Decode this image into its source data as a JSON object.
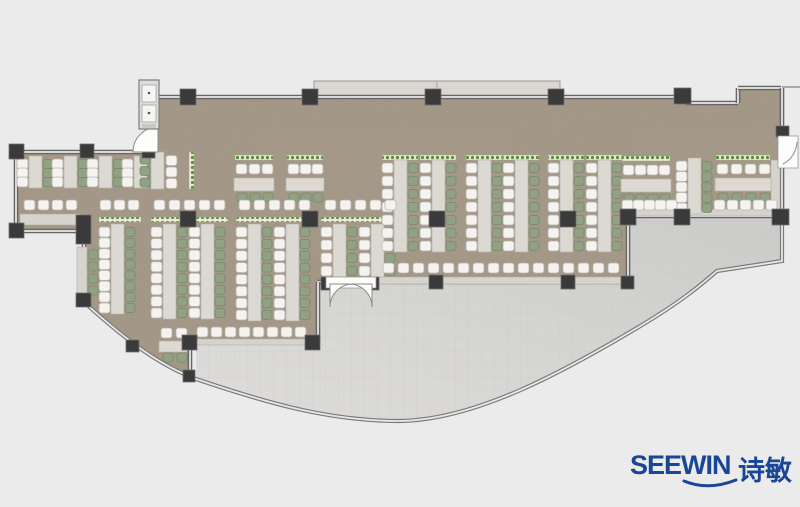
{
  "canvas": {
    "width": 800,
    "height": 507,
    "background": "#ebebeb"
  },
  "logo": {
    "brand": "SEEWIN",
    "cjk": "诗敏",
    "color": "#1a4697"
  },
  "palette": {
    "floor": "#a39685",
    "floor_noise_rgb": "0.40 0.36 0.31",
    "terrace_dark": "#cbcbc9",
    "terrace_light": "#dedddb",
    "tile_line": "#c6c6c4",
    "wall_dark": "#666666",
    "wall_light": "#d9d9d7",
    "glass_dark": "#7a7a7a",
    "glass_light": "#e8e8e6",
    "column": "#3a3a3a",
    "column_edge": "#707070",
    "desk": "#dcd9d2",
    "desk_edge": "#b5b2aa",
    "chair_white": "#f4f3f0",
    "chair_white_edge": "#b9b6af",
    "chair_green": "#91a183",
    "chair_green_edge": "#78886a",
    "planter_bg": "#e8edd9",
    "planter_dot": "#5e8c3c",
    "counter": "#d6d3cc",
    "counter_edge": "#b0ada6",
    "canopy": "#d9d7d0",
    "canopy_edge": "#9a9a98",
    "door_white": "#fdfdfc",
    "door_arc": "#8a8a8a",
    "lobby_bg": "#dedddb",
    "lobby_panel": "#f5f5f3"
  },
  "floorplan": {
    "floor_path": "M158,99 L686,99 L686,105 L738,105 L738,90 L780,90 L780,215 L628,215 L628,281 L318,281 L318,341 L191,341 L191,377 C162,364 128,341 85,301 L85,231 L17,231 L17,153 L158,153 Z",
    "terrace_path": "M196,379 L196,343 L318,343 L318,283 L628,283 L628,217 L781,217 L781,261 L717,271 C702,284 682,301 642,325 C562,373 475,420 400,421 C330,421 270,404 196,379 Z",
    "glass_path": "M84,302 C130,344 162,366 196,379 C270,404 330,421 400,421 C475,420 562,373 642,325 C682,301 702,284 717,271 L782,261 L782,217",
    "walls": [
      [
        155,
        97,
        686,
        97
      ],
      [
        686,
        103,
        738,
        103
      ],
      [
        738,
        103,
        738,
        88
      ],
      [
        738,
        88,
        781,
        88
      ],
      [
        782,
        88,
        782,
        138
      ],
      [
        782,
        166,
        782,
        217
      ],
      [
        782,
        216,
        628,
        216
      ],
      [
        628,
        216,
        628,
        282
      ],
      [
        628,
        282,
        372,
        282
      ],
      [
        330,
        282,
        318,
        282
      ],
      [
        318,
        282,
        318,
        342
      ],
      [
        318,
        342,
        190,
        342
      ],
      [
        190,
        342,
        190,
        377
      ],
      [
        84,
        302,
        84,
        231
      ],
      [
        84,
        231,
        16,
        231
      ],
      [
        16,
        231,
        16,
        152
      ],
      [
        16,
        152,
        158,
        152
      ]
    ],
    "top_line": [
      782,
      87,
      800,
      87
    ],
    "canopy": {
      "x": 314,
      "y": 81,
      "w": 246,
      "h": 15,
      "seam": 437
    },
    "columns": [
      [
        180,
        89,
        16,
        16
      ],
      [
        302,
        89,
        16,
        16
      ],
      [
        425,
        89,
        16,
        16
      ],
      [
        548,
        89,
        16,
        16
      ],
      [
        674,
        88,
        17,
        16
      ],
      [
        776,
        126,
        13,
        11
      ],
      [
        772,
        209,
        17,
        16
      ],
      [
        674,
        209,
        16,
        16
      ],
      [
        620,
        209,
        16,
        16
      ],
      [
        429,
        275,
        14,
        14
      ],
      [
        561,
        275,
        14,
        14
      ],
      [
        621,
        276,
        13,
        13
      ],
      [
        305,
        335,
        15,
        15
      ],
      [
        182,
        335,
        15,
        15
      ],
      [
        126,
        340,
        13,
        12
      ],
      [
        183,
        370,
        12,
        12
      ],
      [
        76,
        215,
        15,
        29
      ],
      [
        76,
        293,
        15,
        14
      ],
      [
        9,
        144,
        15,
        15
      ],
      [
        9,
        223,
        15,
        15
      ],
      [
        80,
        144,
        14,
        14
      ],
      [
        142,
        145,
        13,
        13
      ],
      [
        180,
        211,
        16,
        16
      ],
      [
        302,
        211,
        16,
        16
      ],
      [
        429,
        211,
        16,
        16
      ],
      [
        560,
        211,
        16,
        16
      ],
      [
        321,
        277,
        10,
        13
      ],
      [
        369,
        277,
        10,
        13
      ]
    ],
    "benches_v": [
      {
        "x": 17,
        "y": 156,
        "h": 32,
        "n": 3
      },
      {
        "x": 52,
        "y": 156,
        "h": 32,
        "n": 3
      },
      {
        "x": 87,
        "y": 156,
        "h": 32,
        "n": 3
      },
      {
        "x": 122,
        "y": 156,
        "h": 32,
        "n": 3
      },
      {
        "x": 140,
        "y": 152,
        "h": 37,
        "n": 3,
        "rev": true
      },
      {
        "x": 99,
        "y": 224,
        "h": 90,
        "n": 8
      },
      {
        "x": 151,
        "y": 224,
        "h": 95,
        "n": 8
      },
      {
        "x": 189,
        "y": 224,
        "h": 95,
        "n": 8
      },
      {
        "x": 236,
        "y": 224,
        "h": 97,
        "n": 8
      },
      {
        "x": 274,
        "y": 224,
        "h": 97,
        "n": 8
      },
      {
        "x": 321,
        "y": 224,
        "h": 53,
        "n": 4
      },
      {
        "x": 359,
        "y": 224,
        "h": 53,
        "n": 4
      },
      {
        "x": 382,
        "y": 160,
        "h": 92,
        "n": 7
      },
      {
        "x": 420,
        "y": 160,
        "h": 92,
        "n": 7
      },
      {
        "x": 466,
        "y": 160,
        "h": 92,
        "n": 7
      },
      {
        "x": 503,
        "y": 160,
        "h": 92,
        "n": 7
      },
      {
        "x": 548,
        "y": 160,
        "h": 92,
        "n": 7
      },
      {
        "x": 586,
        "y": 160,
        "h": 92,
        "n": 7
      },
      {
        "x": 676,
        "y": 158,
        "h": 56,
        "n": 5
      }
    ],
    "benches_h": [
      {
        "x": 235,
        "y": 155,
        "w": 38,
        "n": 3
      },
      {
        "x": 287,
        "y": 155,
        "w": 36,
        "n": 3
      },
      {
        "x": 622,
        "y": 156,
        "w": 48,
        "n": 4
      },
      {
        "x": 716,
        "y": 155,
        "w": 54,
        "n": 4
      }
    ],
    "chair_rows": [
      {
        "x": 100,
        "y": 200,
        "n": 3,
        "p": 14,
        "c": "w"
      },
      {
        "x": 154,
        "y": 200,
        "n": 5,
        "p": 15,
        "c": "w"
      },
      {
        "x": 239,
        "y": 200,
        "n": 5,
        "p": 15,
        "c": "w"
      },
      {
        "x": 325,
        "y": 200,
        "n": 5,
        "p": 15,
        "c": "w"
      },
      {
        "x": 24,
        "y": 200,
        "n": 4,
        "p": 14,
        "c": "w"
      },
      {
        "x": 383,
        "y": 263,
        "n": 16,
        "p": 15,
        "c": "w"
      },
      {
        "x": 197,
        "y": 327,
        "n": 8,
        "p": 14,
        "c": "w"
      },
      {
        "x": 622,
        "y": 200,
        "n": 5,
        "p": 11,
        "c": "w"
      },
      {
        "x": 714,
        "y": 200,
        "n": 5,
        "p": 13,
        "c": "w"
      },
      {
        "x": 88,
        "y": 250,
        "n": 4,
        "p": 12,
        "c": "g",
        "vert": true
      },
      {
        "x": 161,
        "y": 328,
        "n": 2,
        "p": 15,
        "c": "w"
      },
      {
        "x": 163,
        "y": 353,
        "n": 2,
        "p": 14,
        "c": "g"
      }
    ],
    "tables": [
      [
        159,
        341,
        28,
        11
      ]
    ],
    "counters": [
      [
        20,
        214,
        60,
        11
      ],
      [
        77,
        247,
        10,
        50
      ],
      [
        378,
        277,
        248,
        7
      ],
      [
        194,
        339,
        118,
        6
      ],
      [
        622,
        209,
        158,
        7
      ],
      [
        771,
        160,
        9,
        52
      ]
    ],
    "planters": [
      [
        99,
        217,
        42,
        5
      ],
      [
        151,
        217,
        77,
        5
      ],
      [
        236,
        217,
        76,
        5
      ],
      [
        321,
        217,
        76,
        5
      ],
      [
        382,
        155,
        36,
        5
      ],
      [
        420,
        155,
        36,
        5
      ],
      [
        466,
        155,
        36,
        5
      ],
      [
        503,
        155,
        36,
        5
      ],
      [
        548,
        155,
        36,
        5
      ],
      [
        586,
        155,
        36,
        5
      ],
      [
        189,
        152,
        5,
        37
      ]
    ],
    "doors": {
      "west_leaf": "M158,152 L158,127 A25,25 0 0 0 133,152 Z",
      "entry_frame": [
        326,
        277,
        50,
        11
      ],
      "entry_leaf_left": "M330,284 L330,307 A23,23 0 0 1 353,284 Z",
      "entry_leaf_right": "M372,284 L372,307 A23,23 0 0 0 349,284 Z",
      "right_frame": [
        778,
        136,
        20,
        32
      ],
      "right_arc": "M783,164 A26,26 0 0 0 797,142"
    },
    "lobby": {
      "box": [
        139,
        80,
        20,
        49
      ],
      "panels": [
        [
          142,
          85,
          14,
          17
        ],
        [
          142,
          105,
          14,
          17
        ]
      ],
      "dots": [
        [
          149,
          93
        ],
        [
          149,
          113
        ]
      ],
      "step": [
        142,
        124,
        14,
        4
      ]
    }
  }
}
